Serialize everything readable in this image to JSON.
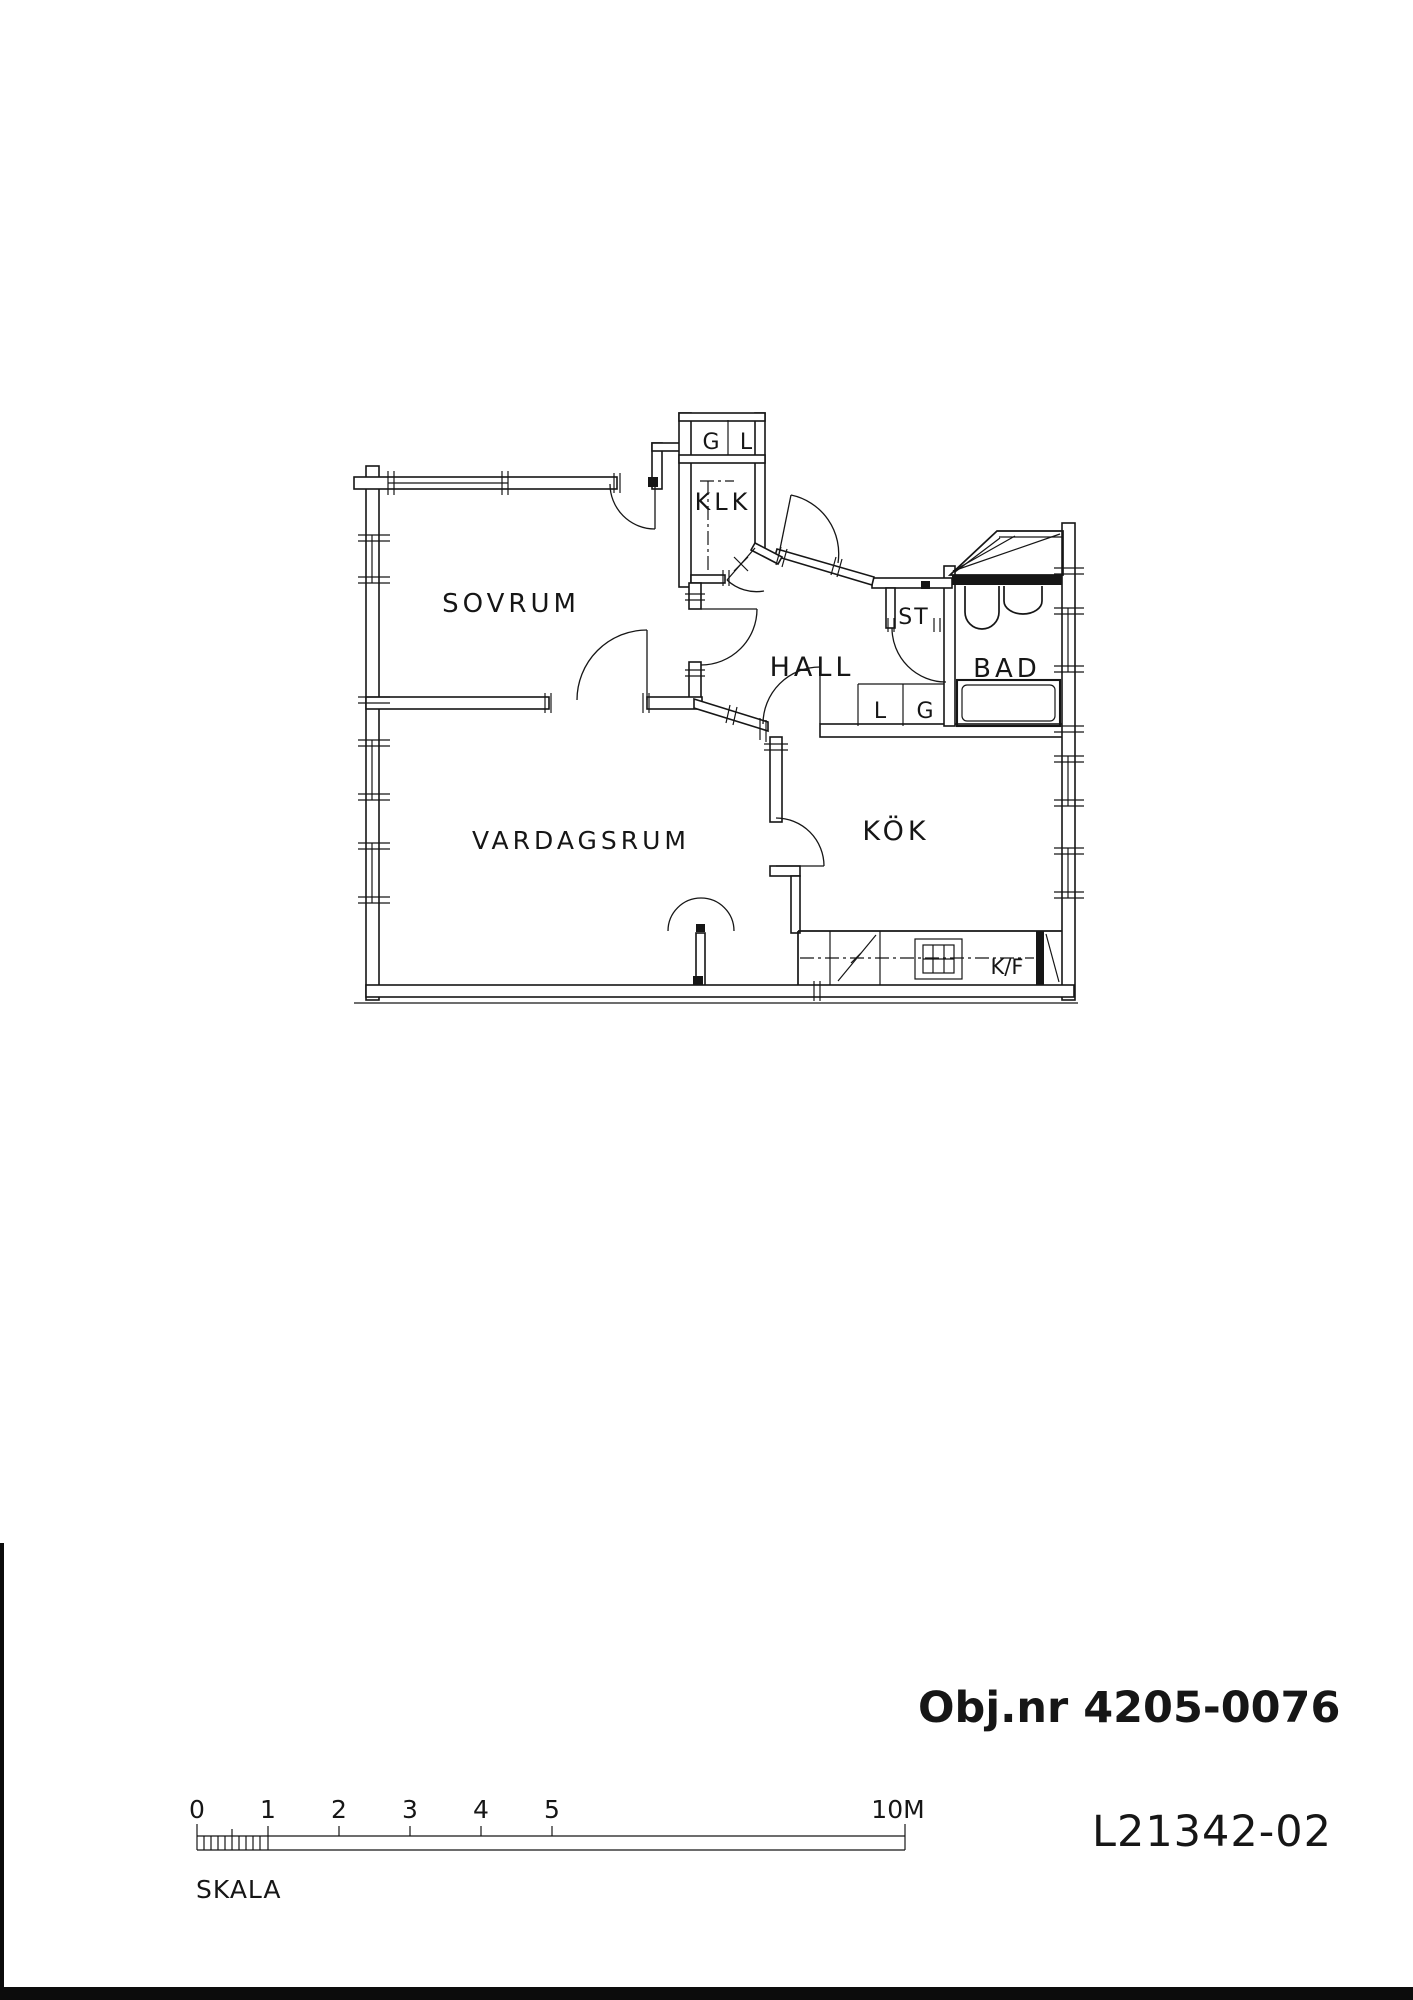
{
  "document": {
    "object_number": "Obj.nr 4205-0076",
    "drawing_number": "L21342-02"
  },
  "floor_plan": {
    "rooms": {
      "sovrum": "SOVRUM",
      "vardagsrum": "VARDAGSRUM",
      "hall": "HALL",
      "kok": "KÖK",
      "bad": "BAD",
      "klk": "KLK"
    },
    "closets": {
      "top_g": "G",
      "top_l": "L",
      "st": "ST",
      "hall_l": "L",
      "hall_g": "G"
    },
    "kitchen": {
      "fridge_freezer": "K/F"
    }
  },
  "scale_bar": {
    "label": "SKALA",
    "ticks": [
      "0",
      "1",
      "2",
      "3",
      "4",
      "5"
    ],
    "end_label": "10M"
  }
}
